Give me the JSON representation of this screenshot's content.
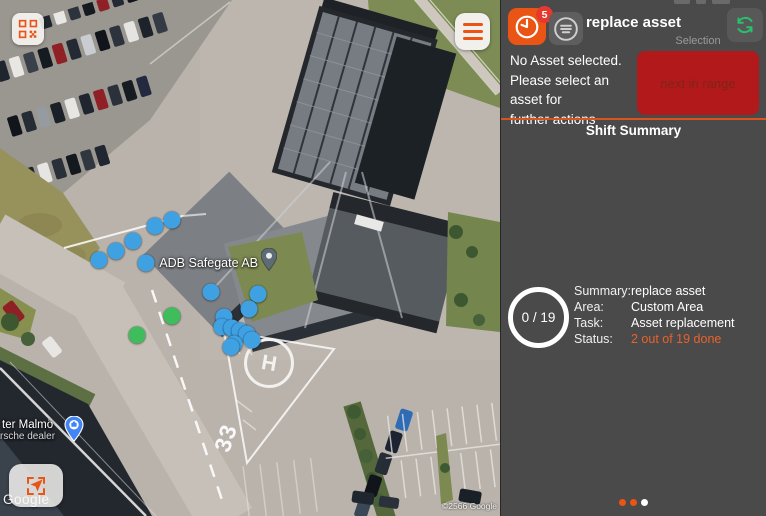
{
  "panel": {
    "header": {
      "title": "replace asset",
      "badge": "5"
    },
    "message_lines": [
      "No Asset selected.",
      "Please select an asset for",
      "further actions"
    ],
    "selection_label": "Selection",
    "next_button_label": "next in range",
    "shift_summary_title": "Shift Summary",
    "progress_text": "0 / 19",
    "summary_rows": [
      {
        "label": "Summary:",
        "value": "replace asset"
      },
      {
        "label": "Area:",
        "value": "Custom Area"
      },
      {
        "label": "Task:",
        "value": "Asset replacement"
      },
      {
        "label": "Status:",
        "value": "2 out of 19 done"
      }
    ],
    "pagination": {
      "total": 3,
      "active_index": 2
    }
  },
  "map": {
    "place_label": "ADB Safegate AB",
    "dealer_label_line1": "ter Malmö",
    "dealer_label_line2": "rsche dealer",
    "helipad_letter": "H",
    "runway_marking": "33",
    "google_watermark": "Google",
    "copyright_text": "©2566 Google",
    "asset_dots": [
      {
        "x": 99,
        "y": 260,
        "status": "open"
      },
      {
        "x": 116,
        "y": 251,
        "status": "open"
      },
      {
        "x": 133,
        "y": 241,
        "status": "open"
      },
      {
        "x": 155,
        "y": 226,
        "status": "open"
      },
      {
        "x": 172,
        "y": 220,
        "status": "open"
      },
      {
        "x": 146,
        "y": 263,
        "status": "open"
      },
      {
        "x": 211,
        "y": 292,
        "status": "open"
      },
      {
        "x": 258,
        "y": 294,
        "status": "open"
      },
      {
        "x": 249,
        "y": 309,
        "status": "open"
      },
      {
        "x": 224,
        "y": 317,
        "status": "open"
      },
      {
        "x": 222,
        "y": 327,
        "status": "open"
      },
      {
        "x": 232,
        "y": 328,
        "status": "open"
      },
      {
        "x": 240,
        "y": 331,
        "status": "open"
      },
      {
        "x": 247,
        "y": 334,
        "status": "open"
      },
      {
        "x": 252,
        "y": 340,
        "status": "open"
      },
      {
        "x": 234,
        "y": 344,
        "status": "open"
      },
      {
        "x": 231,
        "y": 347,
        "status": "open"
      },
      {
        "x": 172,
        "y": 316,
        "status": "done"
      },
      {
        "x": 137,
        "y": 335,
        "status": "done"
      }
    ]
  },
  "colors": {
    "accent_orange": "#EA5515",
    "alert_red": "#B2191B",
    "status_orange": "#E8622D",
    "dot_open": "#3FA0E2",
    "dot_done": "#3FBC5C",
    "refresh_green": "#27C06B",
    "badge_red": "#E5392E",
    "page_dot_active": "#FFFFFF"
  }
}
